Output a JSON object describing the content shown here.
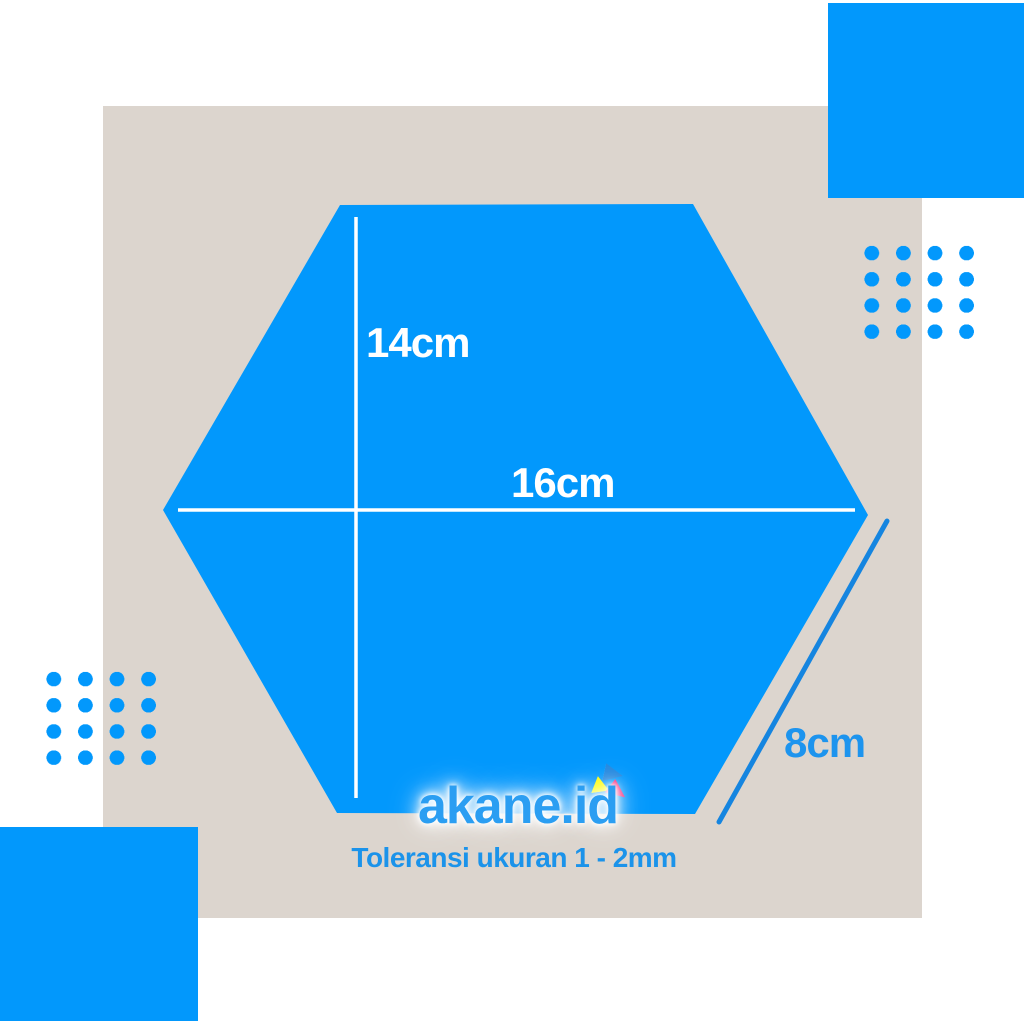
{
  "labels": {
    "height": "14cm",
    "width": "16cm",
    "side": "8cm",
    "tolerance": "Toleransi ukuran 1 - 2mm"
  },
  "watermark": {
    "text": "akane.id"
  },
  "dimensions": {
    "height_cm": "14",
    "width_cm": "16",
    "side_cm": "8",
    "tolerance_range_mm": "1 - 2"
  },
  "shape": {
    "type": "hexagon",
    "sides": 6
  },
  "colors": {
    "primary_blue": "#0298fc",
    "background_beige": "#dcd5ce",
    "canvas_white": "#ffffff",
    "measure_line_white": "#ffffff",
    "side_line_blue": "#1585e0",
    "text_blue": "#1b93ea",
    "watermark_blue": "#2b9ef2",
    "triangle_yellow": "#fdfd02",
    "triangle_blue": "#2288e0",
    "triangle_pink": "#f62178"
  }
}
